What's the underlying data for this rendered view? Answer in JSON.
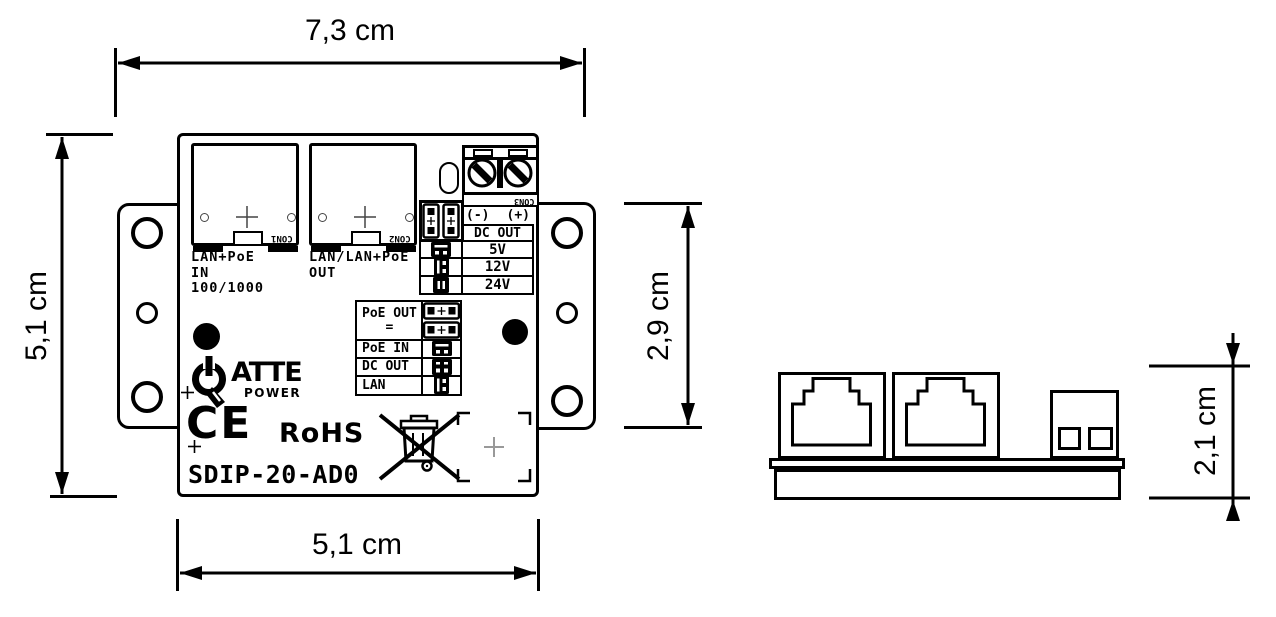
{
  "dimensions": {
    "overall_width": "7,3 cm",
    "body_height": "5,1 cm",
    "bracket_height": "2,9 cm",
    "body_width": "5,1 cm",
    "side_height": "2,1 cm"
  },
  "front_view": {
    "con1": {
      "ref": "CON1",
      "label": [
        "LAN+PoE",
        "IN",
        "100/1000"
      ]
    },
    "con2": {
      "ref": "CON2",
      "label": [
        "LAN/LAN+PoE",
        "OUT"
      ]
    },
    "con3": {
      "ref": "CON3",
      "neg": "(-)",
      "pos": "(+)"
    },
    "dc_table": {
      "header": "DC OUT",
      "rows": [
        "5V",
        "12V",
        "24V"
      ]
    },
    "mode_table": {
      "rows": [
        "PoE OUT",
        "PoE IN",
        "DC OUT",
        "LAN"
      ],
      "row1_sub": "="
    },
    "branding": {
      "logo": "ATTE",
      "logo_sub": "POWER",
      "ce": "CE",
      "rohs": "RoHS",
      "model": "SDIP-20-AD0"
    }
  },
  "colors": {
    "line": "#000000",
    "background": "#ffffff",
    "fiducial_gray": "#999999"
  }
}
